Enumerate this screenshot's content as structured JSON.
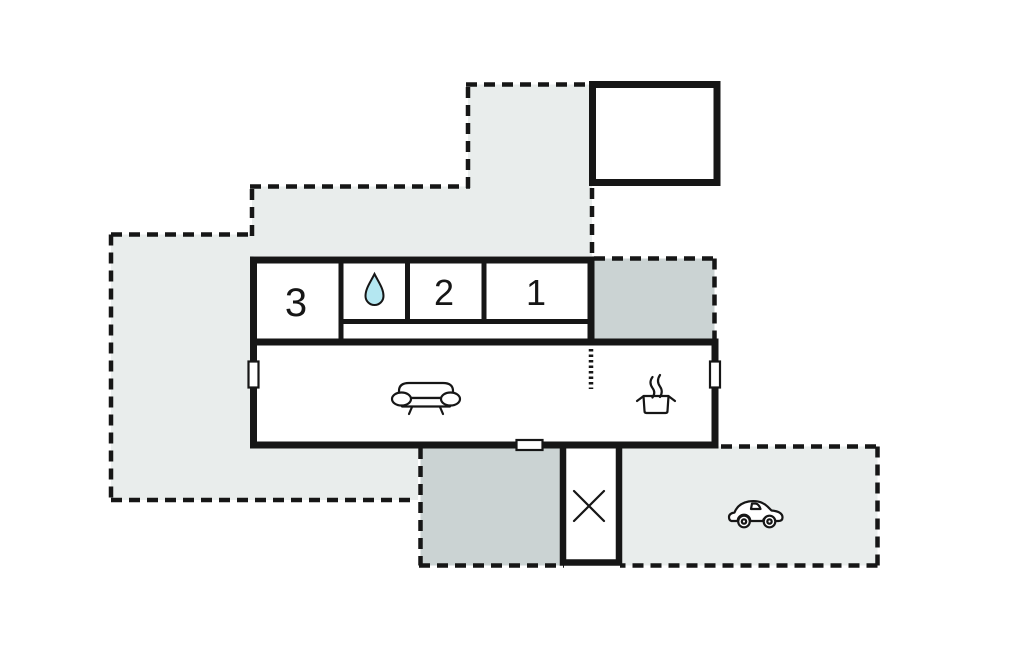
{
  "plan": {
    "type": "holiday-home-floor-plan",
    "rooms": {
      "bedroom_3": {
        "label": "3"
      },
      "bedroom_2": {
        "label": "2"
      },
      "bedroom_1": {
        "label": "1"
      },
      "bathroom": {
        "icon": "water-drop"
      },
      "living_room": {
        "icon": "sofa"
      },
      "kitchen": {
        "icon": "cooking-pot"
      },
      "entrance_hall": {
        "icon": "diagonal-cross"
      },
      "carport": {
        "icon": "car"
      },
      "garage": {},
      "covered_terrace": {},
      "terrace": {},
      "garden": {}
    },
    "colors": {
      "wall": "#161616",
      "area_light": "#e9edec",
      "area_dark": "#cbd3d3",
      "water_drop": "#b4e7f1",
      "background": "#ffffff"
    }
  }
}
